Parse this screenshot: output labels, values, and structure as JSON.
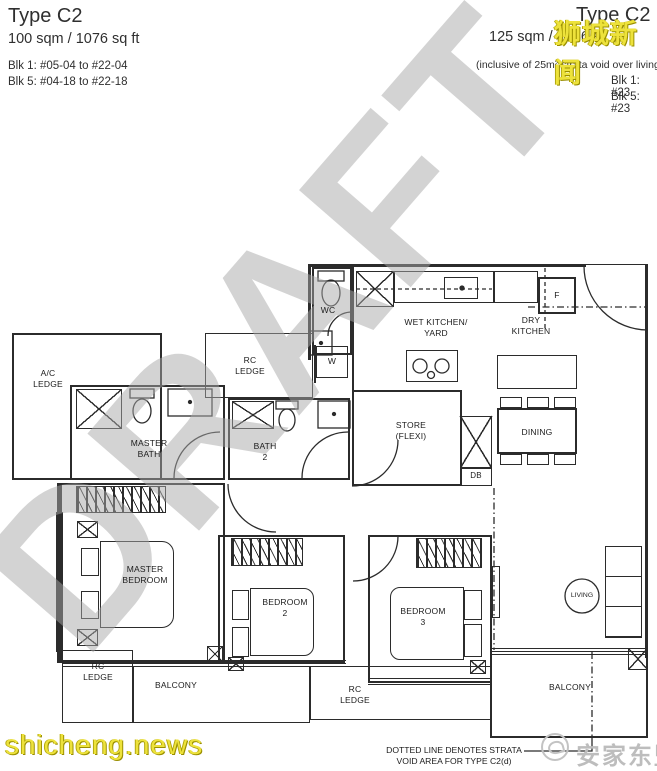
{
  "header_left": {
    "title": "Type C2",
    "area": "100 sqm / 1076 sq ft",
    "blk1": "Blk 1: #05-04 to #22-04",
    "blk5": "Blk 5: #04-18 to #22-18"
  },
  "header_right": {
    "title": "Type C2",
    "area": "125 sqm / 1346 s",
    "note": "(inclusive of 25m² strata void over living/di",
    "blk1": "Blk 1: #23",
    "blk5": "Blk 5: #23"
  },
  "watermarks": {
    "draft": "DRAFT",
    "news_cn": "狮城新闻",
    "news_site": "shicheng.news",
    "agency": "安家东盟",
    "yellow_color": "#ede23b",
    "gray_color": "#bdbdbd"
  },
  "rooms": {
    "ac_ledge": "A/C\nLEDGE",
    "rc_ledge_top": "RC\nLEDGE",
    "master_bath": "MASTER\nBATH",
    "bath_2": "BATH\n2",
    "wc": "WC",
    "washer": "W",
    "wet_kitchen": "WET KITCHEN/\nYARD",
    "dry_kitchen": "DRY\nKITCHEN",
    "fridge": "F",
    "store": "STORE\n(FLEXI)",
    "db": "DB",
    "dining": "DINING",
    "living": "LIVING",
    "master_bedroom": "MASTER\nBEDROOM",
    "bedroom_2": "BEDROOM\n2",
    "bedroom_3": "BEDROOM\n3",
    "rc_ledge_bottom_left": "RC\nLEDGE",
    "rc_ledge_bottom_center": "RC\nLEDGE",
    "balcony_left": "BALCONY",
    "balcony_right": "BALCONY"
  },
  "footnote": "DOTTED LINE DENOTES STRATA\nVOID AREA FOR TYPE C2(d)"
}
